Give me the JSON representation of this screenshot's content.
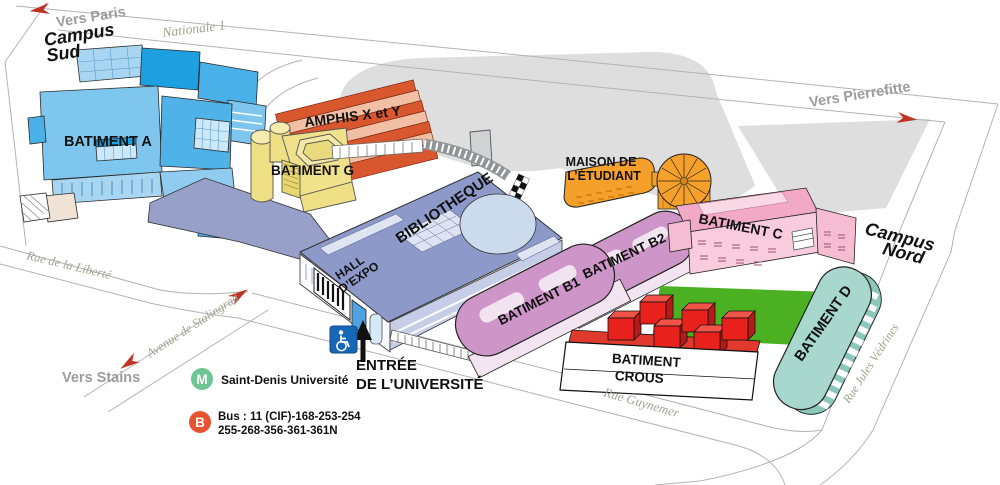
{
  "labels": {
    "vers_paris": "Vers Paris",
    "nationale_1": "Nationale 1",
    "campus_sud_1": "Campus",
    "campus_sud_2": "Sud",
    "batiment_a": "BATIMENT A",
    "rue_de_la_liberte": "Rue de la Liberté",
    "amphis": "AMPHIS X et Y",
    "batiment_g": "BATIMENT G",
    "bibliotheque": "BIBLIOTHEQUE",
    "hall_expo_1": "HALL",
    "hall_expo_2": "D’EXPO",
    "maison_1": "MAISON DE",
    "maison_2": "L’ÉTUDIANT",
    "vers_pierrefitte": "Vers Pierrefitte",
    "batiment_c": "BATIMENT C",
    "campus_nord_1": "Campus",
    "campus_nord_2": "Nord",
    "batiment_b1": "BATIMENT B1",
    "batiment_b2": "BATIMENT B2",
    "crous_1": "BATIMENT",
    "crous_2": "CROUS",
    "rue_guynemer": "Rue Guynemer",
    "batiment_d": "BATIMENT D",
    "rue_jules_vedrines": "Rue Jules Védrines",
    "avenue_de_stalingrad": "Avenue de Stalingrad",
    "vers_stains": "Vers Stains",
    "entree_1": "ENTRÉE",
    "entree_2": "DE L’UNIVERSITÉ"
  },
  "transit": {
    "metro_symbol": "M",
    "metro_station": "Saint-Denis Université",
    "bus_symbol": "B",
    "bus_line1": "Bus : 11 (CIF)-168-253-254",
    "bus_line2": "255-268-356-361-361N"
  },
  "colors": {
    "building_blue": "#7FC6EE",
    "building_blue_mid": "#4FB3E8",
    "building_blue_dark": "#1E9FE0",
    "library_slate": "#8C99C9",
    "esplanade_slate": "#97A0C8",
    "batiment_g_yellow": "#F0E18C",
    "amphi_red": "#D9572E",
    "amphi_light": "#F2BFA4",
    "maison_orange": "#F5A02B",
    "batiment_c_pink": "#F2A9C6",
    "batiment_b_mauve": "#CD95C8",
    "crous_red": "#E8211D",
    "crous_deck_red": "#E03A2F",
    "batiment_d_teal": "#A8D7CD",
    "field_green": "#4CB122",
    "area_gray": "#DEDEDE",
    "metro_green": "#6CC592",
    "bus_red": "#E85230",
    "accessibility_blue": "#1767B8",
    "arrow_red": "#BE3426"
  }
}
